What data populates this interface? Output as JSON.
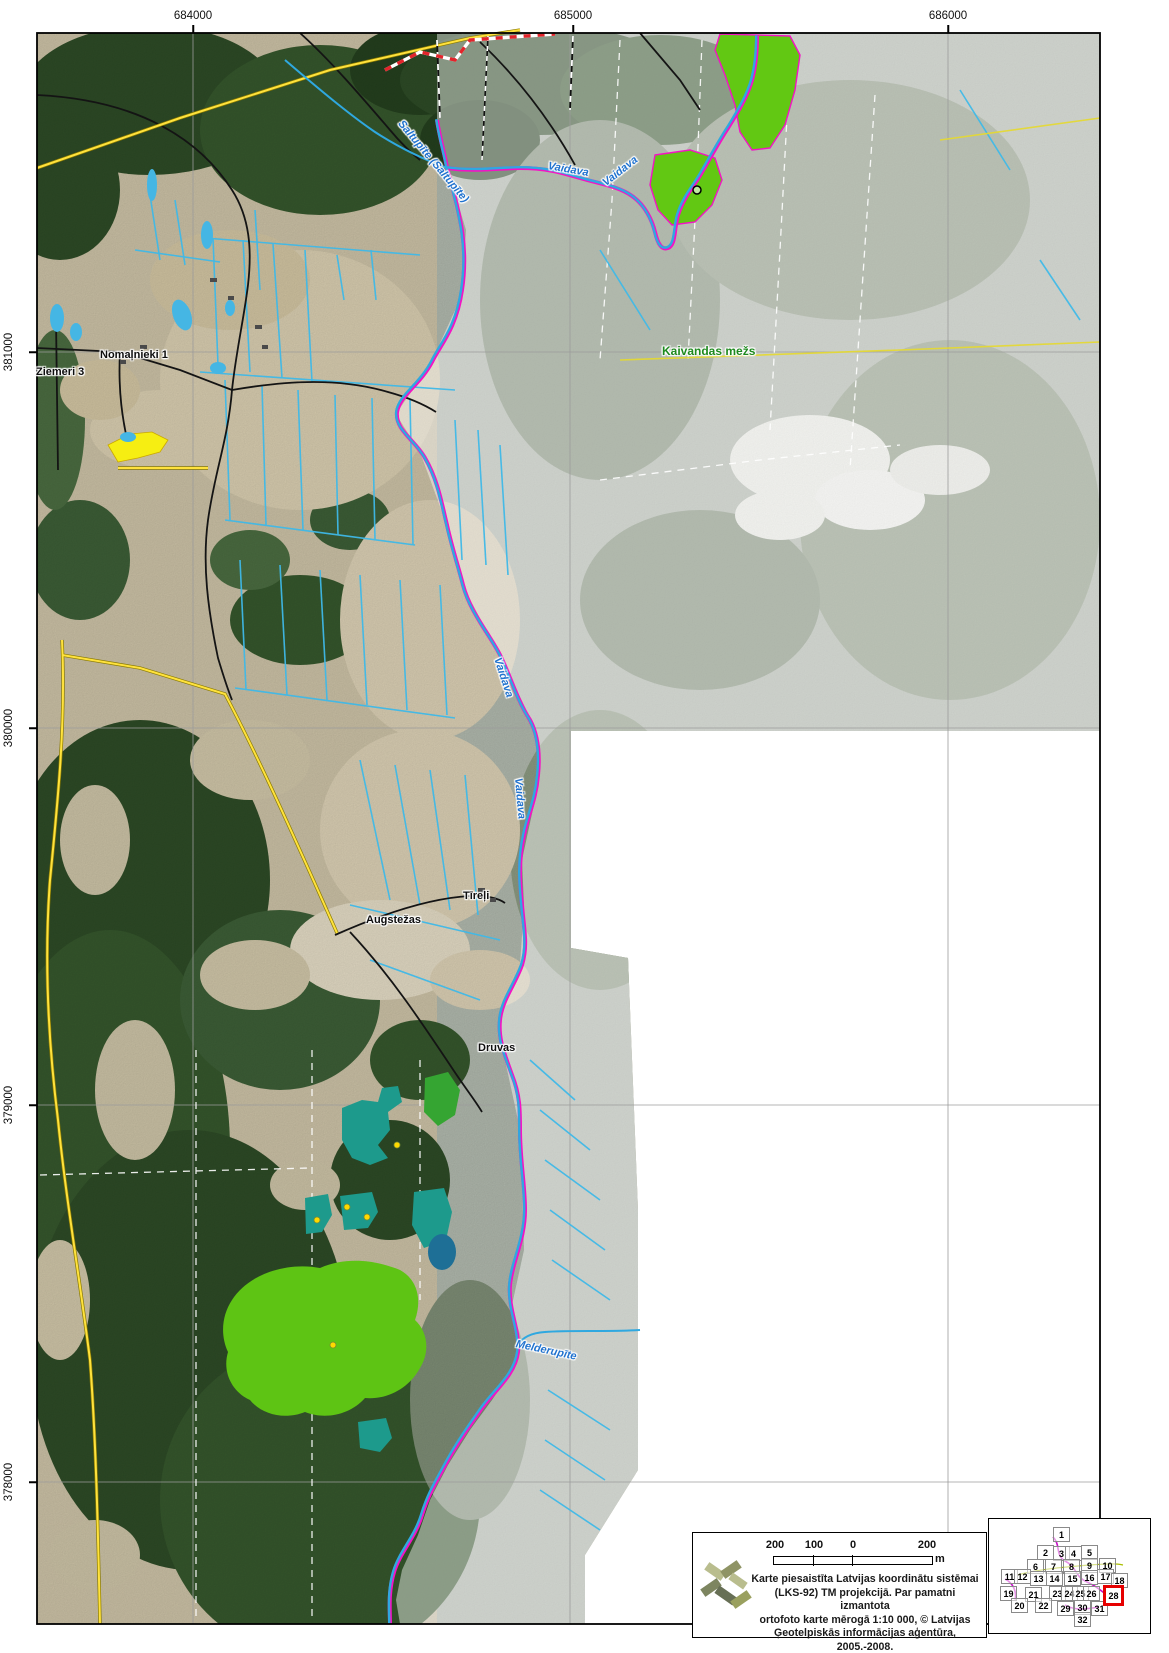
{
  "axes": {
    "top": [
      {
        "text": "684000",
        "x": 193
      },
      {
        "text": "685000",
        "x": 573
      },
      {
        "text": "686000",
        "x": 948
      }
    ],
    "left": [
      {
        "text": "381000",
        "y": 352
      },
      {
        "text": "380000",
        "y": 728
      },
      {
        "text": "379000",
        "y": 1105
      },
      {
        "text": "378000",
        "y": 1482
      }
    ]
  },
  "map_labels": [
    {
      "text": "Nomaļnieki 1",
      "x": 100,
      "y": 349,
      "cls": "place"
    },
    {
      "text": "Ziemeri 3",
      "x": 36,
      "y": 366,
      "cls": "place"
    },
    {
      "text": "Kaivandas mežs",
      "x": 662,
      "y": 344,
      "cls": "forest"
    },
    {
      "text": "Saltupīte (Saltupīte)",
      "x": 400,
      "y": 116,
      "cls": "river",
      "rotate": 50
    },
    {
      "text": "Vaidava",
      "x": 548,
      "y": 160,
      "cls": "river",
      "rotate": 10
    },
    {
      "text": "Vaidava",
      "x": 604,
      "y": 178,
      "cls": "river",
      "rotate": -38
    },
    {
      "text": "Vaidava",
      "x": 497,
      "y": 652,
      "cls": "river",
      "rotate": 72
    },
    {
      "text": "Vaidava",
      "x": 518,
      "y": 772,
      "cls": "river",
      "rotate": 85
    },
    {
      "text": "Melderupīte",
      "x": 516,
      "y": 1338,
      "cls": "river",
      "rotate": 12
    },
    {
      "text": "Tīreļi",
      "x": 463,
      "y": 890,
      "cls": "place"
    },
    {
      "text": "Augstežas",
      "x": 366,
      "y": 914,
      "cls": "place"
    },
    {
      "text": "Druvas",
      "x": 478,
      "y": 1042,
      "cls": "place"
    }
  ],
  "legend": {
    "scale_labels": [
      {
        "text": "200",
        "x": 82
      },
      {
        "text": "100",
        "x": 121
      },
      {
        "text": "0",
        "x": 160
      },
      {
        "text": "200",
        "x": 234
      }
    ],
    "unit": "m",
    "attribution": [
      "Karte piesaistīta Latvijas koordinātu sistēmai",
      "(LKS-92) TM projekcijā. Par pamatni izmantota",
      "ortofoto karte mērogā 1:10 000, © Latvijas",
      "Ģeotelpiskās informācijas aģentūra, 2005.-2008."
    ]
  },
  "index_map": {
    "highlighted_cell": "28",
    "cells": [
      {
        "text": "1",
        "x": 64,
        "y": 8
      },
      {
        "text": "2",
        "x": 48,
        "y": 26
      },
      {
        "text": "3",
        "x": 64,
        "y": 27
      },
      {
        "text": "4",
        "x": 76,
        "y": 27
      },
      {
        "text": "5",
        "x": 92,
        "y": 26
      },
      {
        "text": "6",
        "x": 38,
        "y": 40
      },
      {
        "text": "7",
        "x": 56,
        "y": 40
      },
      {
        "text": "8",
        "x": 74,
        "y": 40
      },
      {
        "text": "9",
        "x": 92,
        "y": 39
      },
      {
        "text": "10",
        "x": 110,
        "y": 39
      },
      {
        "text": "11",
        "x": 12,
        "y": 50
      },
      {
        "text": "12",
        "x": 25,
        "y": 50
      },
      {
        "text": "13",
        "x": 41,
        "y": 52
      },
      {
        "text": "14",
        "x": 57,
        "y": 52
      },
      {
        "text": "15",
        "x": 75,
        "y": 52
      },
      {
        "text": "16",
        "x": 92,
        "y": 51
      },
      {
        "text": "17",
        "x": 108,
        "y": 50
      },
      {
        "text": "18",
        "x": 122,
        "y": 54
      },
      {
        "text": "19",
        "x": 11,
        "y": 67
      },
      {
        "text": "21",
        "x": 36,
        "y": 68
      },
      {
        "text": "23",
        "x": 60,
        "y": 67
      },
      {
        "text": "24",
        "x": 72,
        "y": 67
      },
      {
        "text": "25",
        "x": 83,
        "y": 67
      },
      {
        "text": "26",
        "x": 94,
        "y": 67
      },
      {
        "text": "28",
        "x": 114,
        "y": 66,
        "highlighted": true
      },
      {
        "text": "20",
        "x": 22,
        "y": 79
      },
      {
        "text": "22",
        "x": 46,
        "y": 79
      },
      {
        "text": "29",
        "x": 68,
        "y": 82
      },
      {
        "text": "30",
        "x": 85,
        "y": 81
      },
      {
        "text": "31",
        "x": 102,
        "y": 82
      },
      {
        "text": "32",
        "x": 85,
        "y": 93
      }
    ]
  },
  "colors": {
    "water_line": "#3ab4e6",
    "river_accent": "#f413c4",
    "road_yellow": "#ffe23d",
    "forest_label_green": "#1e8a1e",
    "stand_bright_green": "#62c813",
    "stand_teal": "#1d9a8c",
    "highlight_red": "#e60000",
    "boundary_red_white": "#e3242b"
  }
}
